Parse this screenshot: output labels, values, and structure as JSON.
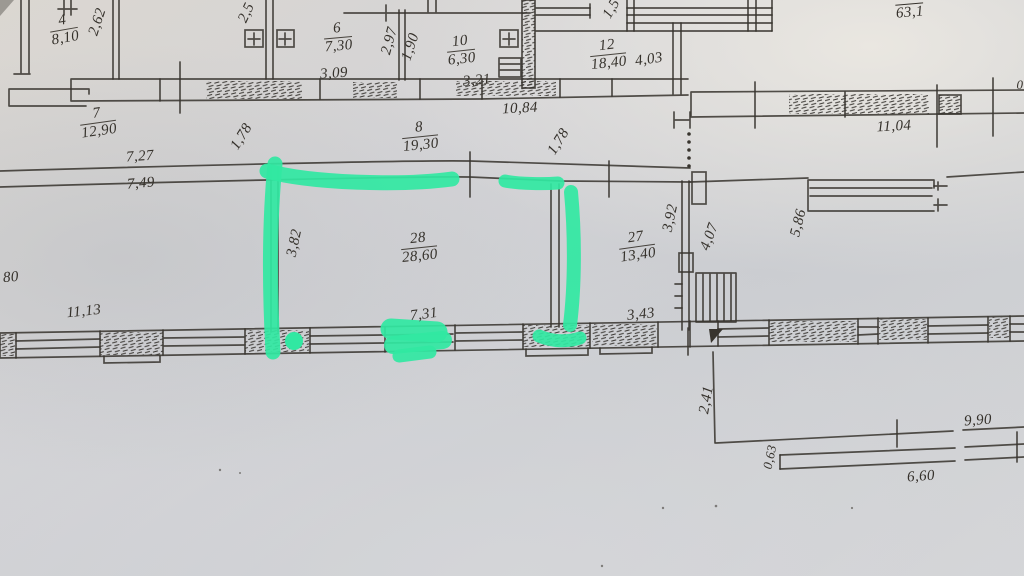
{
  "document": {
    "kind": "hand-drawn floor plan photograph",
    "units": "meters",
    "paper_color": "#d3d3d6",
    "ink_color": "#38342e",
    "highlight_color": "#31e8a2"
  },
  "annotation": {
    "tool": "green-highlighter",
    "marked_room": "28",
    "description": "green marker outlines walls of room 28"
  },
  "rooms": [
    {
      "number": "4",
      "area": "8,10"
    },
    {
      "number": "6",
      "area": "7,30"
    },
    {
      "number": "10",
      "area": "6,30"
    },
    {
      "number": "12",
      "area": "18,40"
    },
    {
      "number": "7",
      "area": "12,90"
    },
    {
      "number": "8",
      "area": "19,30"
    },
    {
      "number": "28",
      "area": "28,60"
    },
    {
      "number": "27",
      "area": "13,40"
    }
  ],
  "dims": {
    "d2_62": "2,62",
    "d2_5": "2,5",
    "d2_97": "2,97",
    "d1_90": "1,90",
    "d3_09": "3,09",
    "d3_21": "3,21",
    "d1_5": "1,5",
    "d4_03": "4,03",
    "d10_84": "10,84",
    "d63_1": "63,1",
    "d11_04": "11,04",
    "d1_78a": "1,78",
    "d1_78b": "1,78",
    "d7_27": "7,27",
    "d7_49": "7,49",
    "d80": "80",
    "d3_82": "3,82",
    "d3_92": "3,92",
    "d4_07": "4,07",
    "d5_86": "5,86",
    "d11_13": "11,13",
    "d7_31": "7,31",
    "d3_43": "3,43",
    "d2_41": "2,41",
    "d9_90": "9,90",
    "d0_63": "0,63",
    "d6_60": "6,60",
    "d0": "0"
  }
}
